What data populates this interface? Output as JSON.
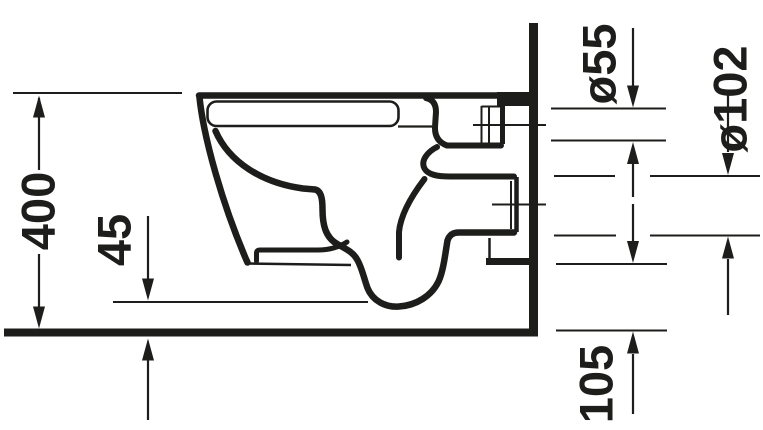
{
  "drawing": {
    "type": "technical-dimension-drawing",
    "subject": "wall-hung-toilet-side-section",
    "ink_color": "#1d1d1b",
    "background_color": "#ffffff",
    "labels": {
      "overall_height": "400",
      "floor_clearance": "45",
      "inlet_diameter": "ø55",
      "outlet_diameter": "ø102",
      "outlet_bottom_height": "105"
    }
  }
}
